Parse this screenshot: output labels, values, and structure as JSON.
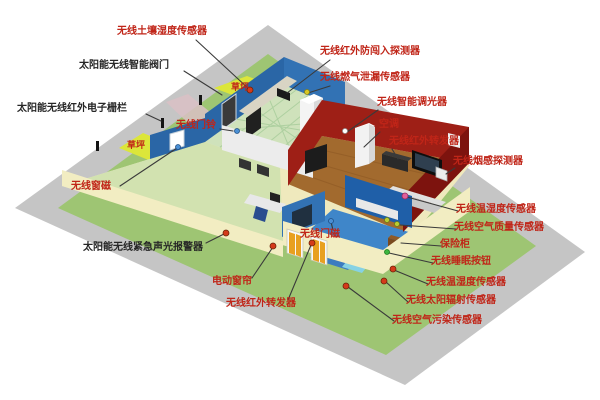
{
  "scene": {
    "description": "智能家居无线传感器布局示意图",
    "type": "isometric smart-home wireless sensor layout diagram"
  },
  "colors": {
    "ground_path": "#c5c5c5",
    "lawn": "#9ec573",
    "lawn_patch": "#dce63a",
    "house_slab": "#efe9bd",
    "wall_cream": "#f2edc2",
    "wall_blue_nw": "#2a66a6",
    "wall_blue_ne": "#3272b4",
    "wall_blue_dark": "#1f5fa8",
    "wall_red": "#9e1f16",
    "wall_red_dark": "#7d130e",
    "wall_white": "#ececec",
    "floor_kitchen": "#cfe2bb",
    "floor_wood": "#a26a2e",
    "floor_study": "#d2e2b0",
    "floor_bedroom": "#3f86c9",
    "path_pink": "#d9bfc4",
    "label_red": "#c02518",
    "label_black": "#262626",
    "leader_line": "#3a3a3a"
  },
  "labels": [
    {
      "id": "soil_moisture_sensor",
      "text": "无线土壤湿度传感器"
    },
    {
      "id": "solar_smart_valve",
      "text": "太阳能无线智能阀门"
    },
    {
      "id": "solar_ir_electric_fence",
      "text": "太阳能无线红外电子栅栏"
    },
    {
      "id": "lawn_top",
      "text": "草坪"
    },
    {
      "id": "lawn_left",
      "text": "草坪"
    },
    {
      "id": "doorbell",
      "text": "无线门铃"
    },
    {
      "id": "window_magnet",
      "text": "无线窗磁"
    },
    {
      "id": "sound_light_alarm",
      "text": "太阳能无线紧急声光报警器"
    },
    {
      "id": "electric_curtain",
      "text": "电动窗帘"
    },
    {
      "id": "ir_repeater_bottom",
      "text": "无线红外转发器"
    },
    {
      "id": "intrusion_detector",
      "text": "无线红外防闯入探测器"
    },
    {
      "id": "gas_leak_sensor",
      "text": "无线燃气泄漏传感器"
    },
    {
      "id": "smart_dimmer",
      "text": "无线智能调光器"
    },
    {
      "id": "air_conditioner",
      "text": "空调"
    },
    {
      "id": "ir_repeater_top",
      "text": "无线红外转发器"
    },
    {
      "id": "smoke_detector",
      "text": "无线烟感探测器"
    },
    {
      "id": "temp_humidity_indoor",
      "text": "无线温湿度传感器"
    },
    {
      "id": "air_quality_sensor",
      "text": "无线空气质量传感器"
    },
    {
      "id": "safe_box",
      "text": "保险柜"
    },
    {
      "id": "sleep_button",
      "text": "无线睡眠按钮"
    },
    {
      "id": "temp_humidity_outdoor",
      "text": "无线温湿度传感器"
    },
    {
      "id": "solar_radiation_sensor",
      "text": "无线太阳辐射传感器"
    },
    {
      "id": "air_pollution_sensor",
      "text": "无线空气污染传感器"
    },
    {
      "id": "door_magnet",
      "text": "无线门磁"
    }
  ],
  "markers": [
    {
      "id": "soil_moisture_marker",
      "color": "#d43a1a"
    },
    {
      "id": "window_magnet_marker",
      "color": "#4a8fd4"
    },
    {
      "id": "doorbell_marker",
      "color": "#4a8fd4"
    },
    {
      "id": "alarm_marker",
      "color": "#d43a1a"
    },
    {
      "id": "curtain_marker",
      "color": "#d43a1a"
    },
    {
      "id": "ir_bottom_marker",
      "color": "#d43a1a"
    },
    {
      "id": "gas_marker",
      "color": "#d8c822"
    },
    {
      "id": "dimmer_marker",
      "color": "#ffffff"
    },
    {
      "id": "temp_indoor_marker",
      "color": "#e0609a"
    },
    {
      "id": "air_quality_marker_1",
      "color": "#b8cc33"
    },
    {
      "id": "air_quality_marker_2",
      "color": "#b8cc33"
    },
    {
      "id": "sleep_button_marker",
      "color": "#3db53d"
    },
    {
      "id": "door_magnet_marker",
      "color": "#4a8fd4"
    },
    {
      "id": "temp_outdoor_marker",
      "color": "#d43a1a"
    },
    {
      "id": "solar_radiation_marker",
      "color": "#d43a1a"
    },
    {
      "id": "air_pollution_marker",
      "color": "#d43a1a"
    }
  ]
}
